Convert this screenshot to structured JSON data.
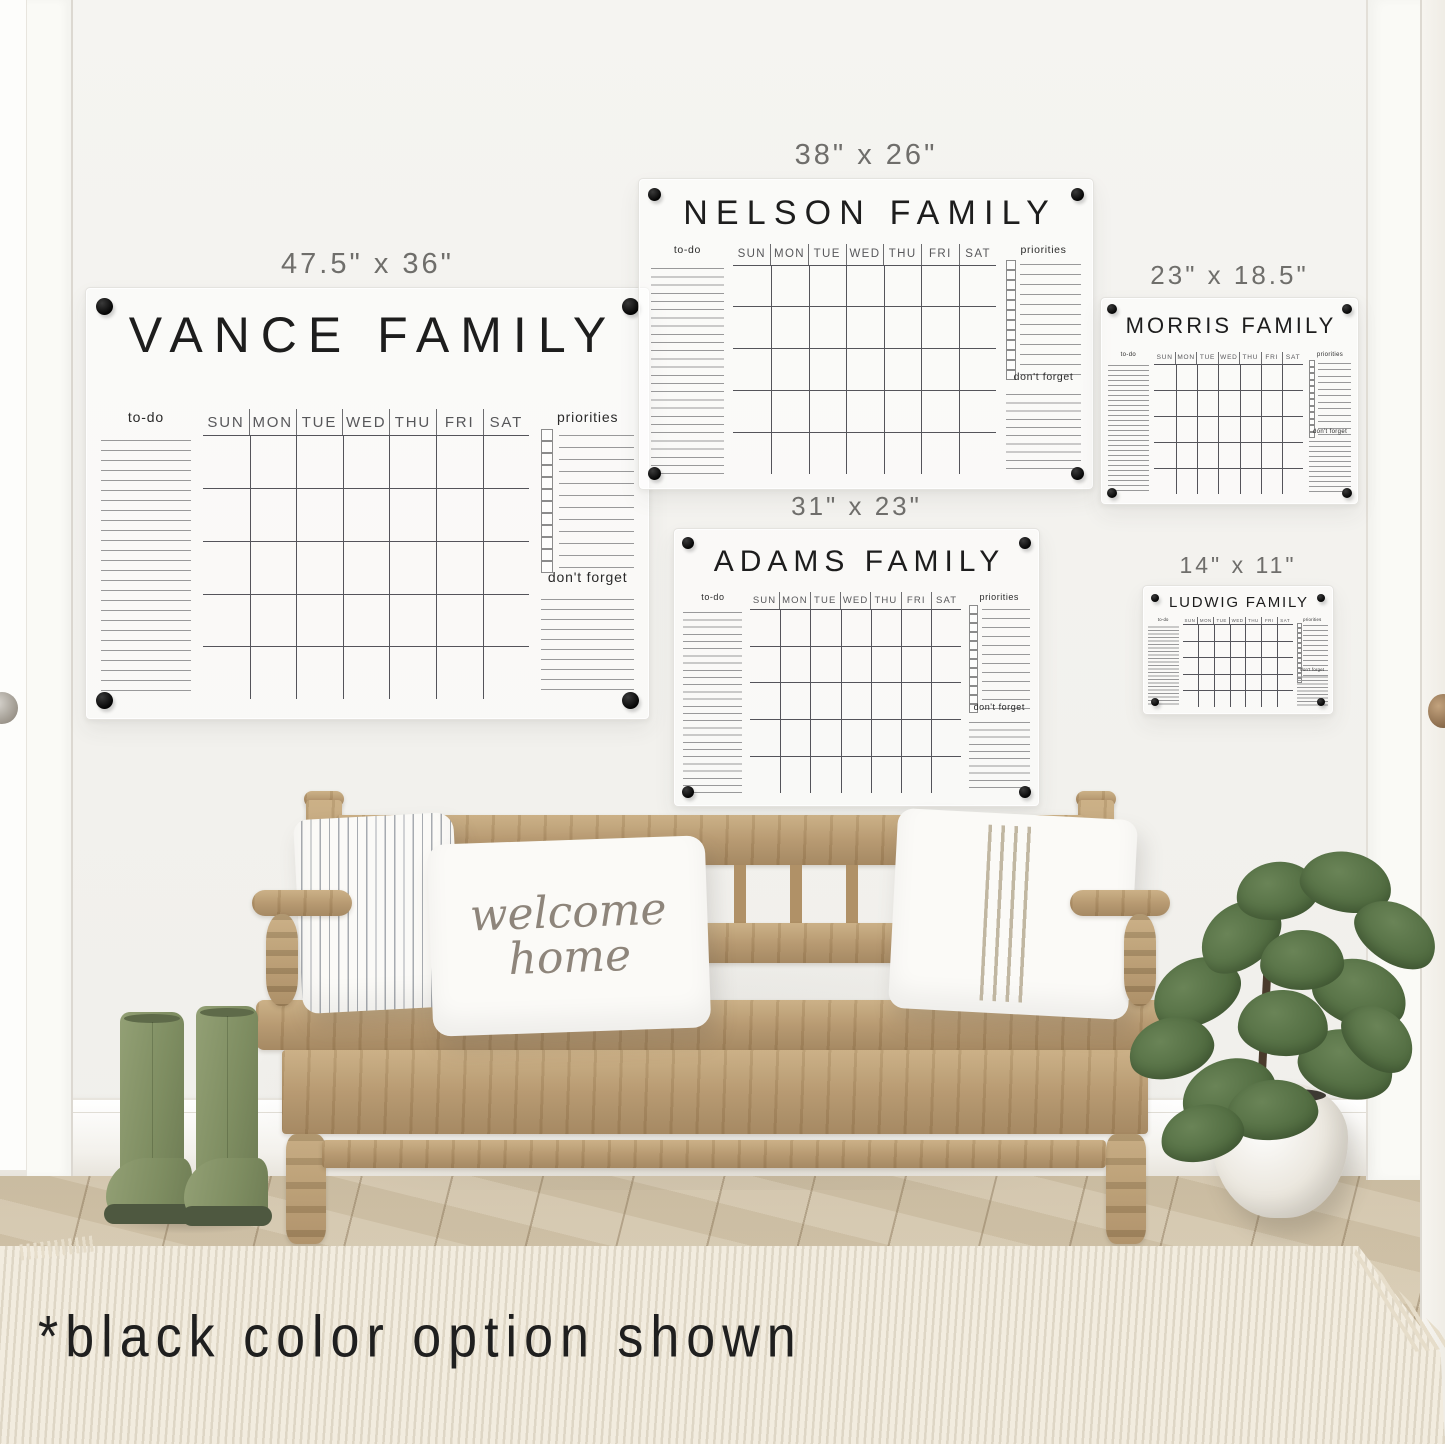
{
  "caption": "*black color option shown",
  "days": [
    "SUN",
    "MON",
    "TUE",
    "WED",
    "THU",
    "FRI",
    "SAT"
  ],
  "board_labels": {
    "todo": "to-do",
    "priorities": "priorities",
    "dont_forget": "don't forget"
  },
  "boards": [
    {
      "id": "vance",
      "family": "VANCE FAMILY",
      "size_label": "47.5\" x 36\""
    },
    {
      "id": "nelson",
      "family": "NELSON FAMILY",
      "size_label": "38\" x 26\""
    },
    {
      "id": "morris",
      "family": "MORRIS FAMILY",
      "size_label": "23\" x 18.5\""
    },
    {
      "id": "adams",
      "family": "ADAMS FAMILY",
      "size_label": "31\" x 23\""
    },
    {
      "id": "ludwig",
      "family": "LUDWIG FAMILY",
      "size_label": "14\" x 11\""
    }
  ],
  "pillow": {
    "line1": "welcome",
    "line2": "home"
  },
  "colors": {
    "marker_black": "#1b1b1b",
    "wall": "#f3f2ee",
    "bench_wood": "#b6996c",
    "boots_green": "#879468",
    "leaf_green": "#55713f",
    "rug_cream": "#ece6da"
  }
}
